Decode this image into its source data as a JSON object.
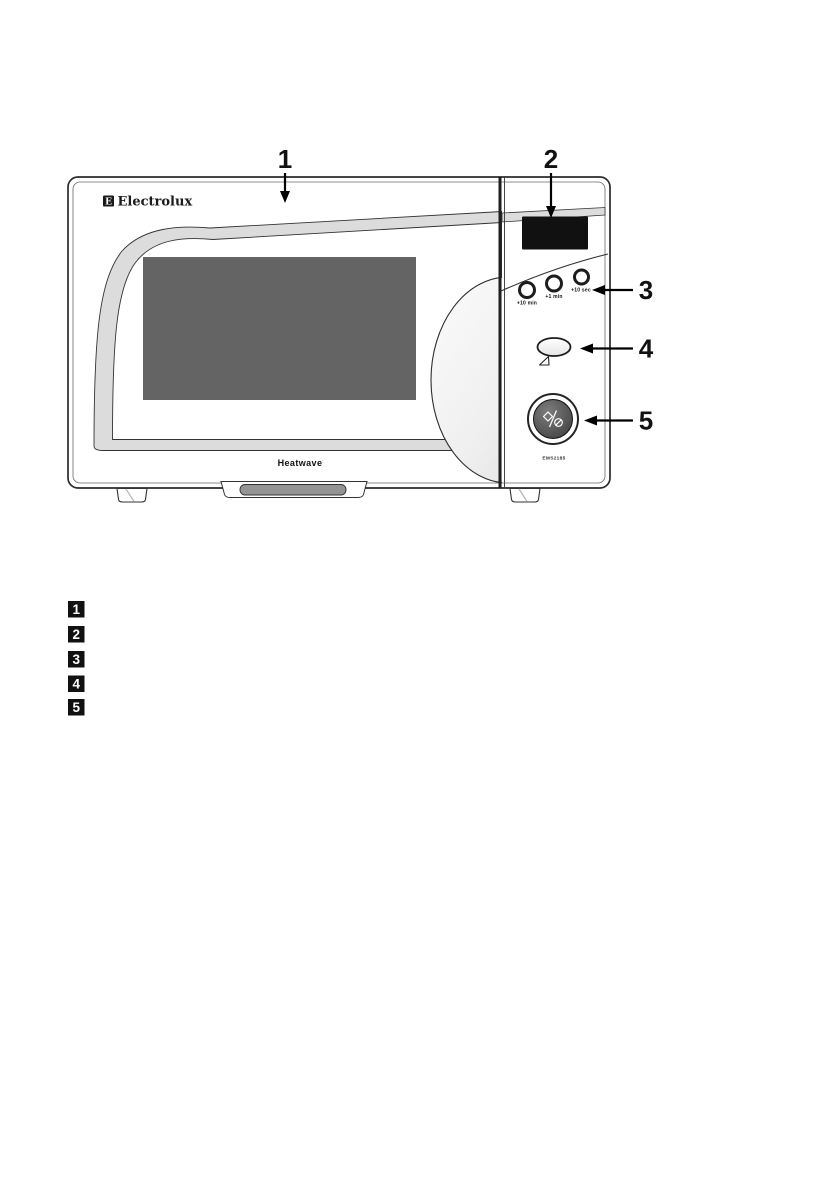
{
  "illustration": {
    "brand": "Electrolux",
    "brand_logo_letter": "E",
    "product_name": "Heatwave",
    "model": "EMS2185",
    "control_panel": {
      "time_buttons": [
        {
          "label": "+10 min"
        },
        {
          "label": "+1 min"
        },
        {
          "label": "+10 sec"
        }
      ]
    }
  },
  "callouts": [
    "1",
    "2",
    "3",
    "4",
    "5"
  ],
  "legend_markers": [
    "1",
    "2",
    "3",
    "4",
    "5"
  ],
  "colors": {
    "door_window": "#646464",
    "display": "#111111",
    "door_trim": "#dcdcdc",
    "outline": "#2b2b2b"
  }
}
